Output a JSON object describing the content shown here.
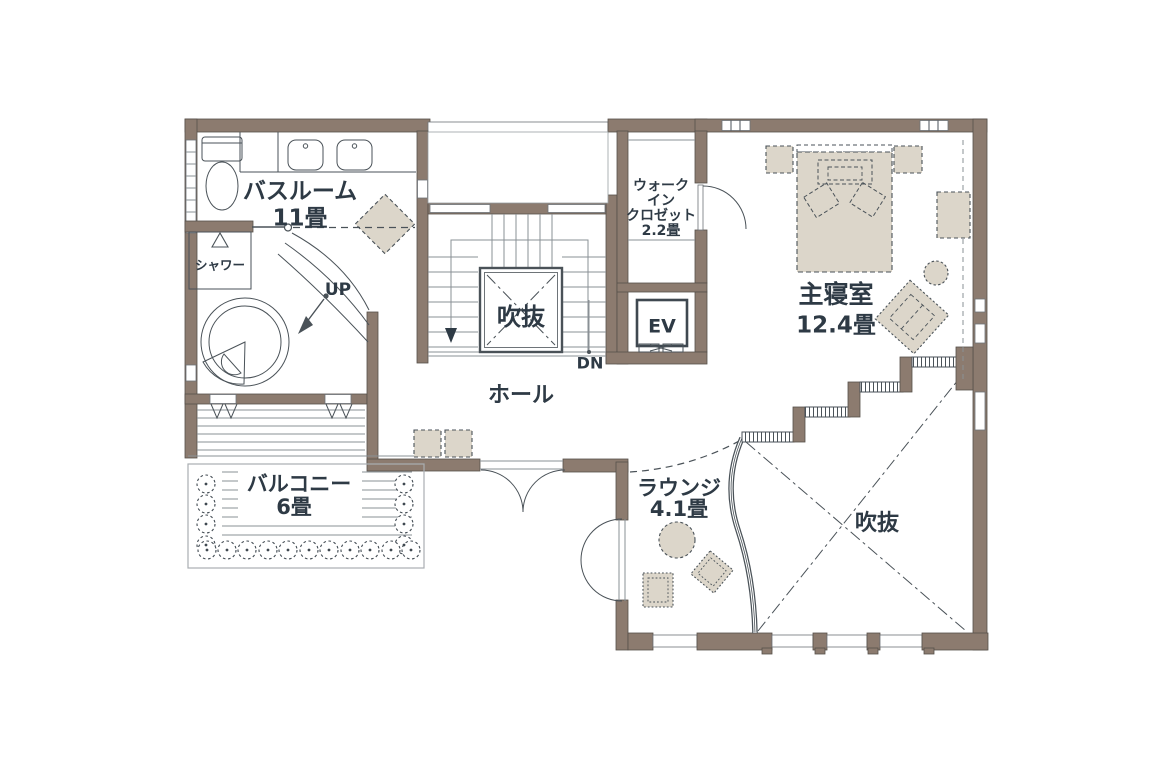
{
  "plan": {
    "title_hint": "second-floor residential floor plan",
    "rooms": {
      "bathroom": {
        "name": "バスルーム",
        "area": "11畳"
      },
      "shower": {
        "name": "シャワー"
      },
      "wic": {
        "lines": [
          "ウォーク",
          "イン",
          "クロゼット",
          "2.2畳"
        ]
      },
      "bedroom": {
        "name": "主寝室",
        "area": "12.4畳"
      },
      "hall": {
        "name": "ホール"
      },
      "balcony": {
        "name": "バルコニー",
        "area": "6畳"
      },
      "lounge": {
        "name": "ラウンジ",
        "area": "4.1畳"
      },
      "stair_void": {
        "name": "吹抜"
      },
      "open_void": {
        "name": "吹抜"
      },
      "elevator": {
        "name": "EV"
      }
    },
    "stairs": {
      "up": "UP",
      "down": "DN"
    },
    "colors": {
      "wall": "#8C7B6F",
      "outline": "#4A5258",
      "text": "#2E3A45",
      "furniture_fill": "#DCD6CA",
      "background": "#FFFFFF"
    }
  }
}
